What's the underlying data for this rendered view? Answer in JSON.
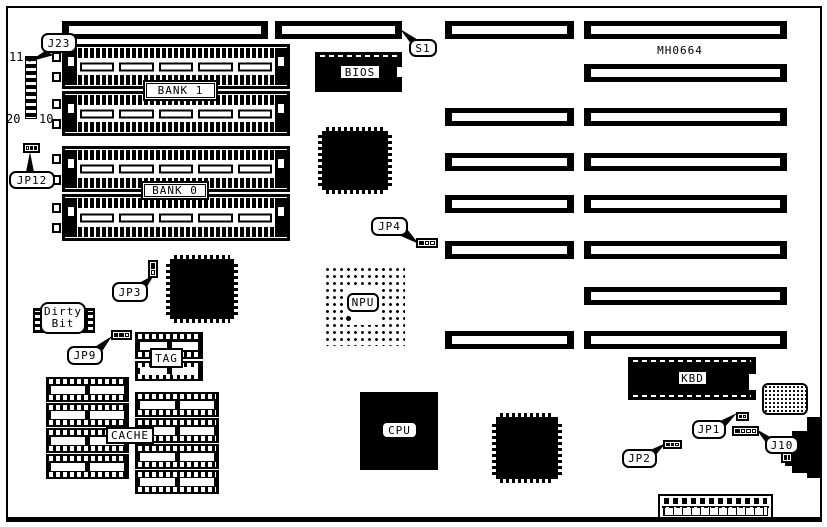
{
  "board": {
    "code": "MH0664",
    "colors": {
      "ink": "#000000",
      "paper": "#ffffff"
    },
    "banks": {
      "bank1": "BANK 1",
      "bank0": "BANK 0"
    },
    "chips": {
      "bios": "BIOS",
      "npu": "NPU",
      "cpu": "CPU",
      "kbd": "KBD",
      "tag": "TAG",
      "cache": "CACHE",
      "dirty_bit": [
        "Dirty",
        "Bit"
      ]
    },
    "connectors": {
      "j23": "J23",
      "s1": "S1",
      "j10": "J10"
    },
    "jumpers": {
      "jp1": "JP1",
      "jp2": "JP2",
      "jp3": "JP3",
      "jp4": "JP4",
      "jp9": "JP9",
      "jp12": "JP12"
    },
    "pin_labels": {
      "p11": "11",
      "p20": "20",
      "p10": "10"
    }
  }
}
